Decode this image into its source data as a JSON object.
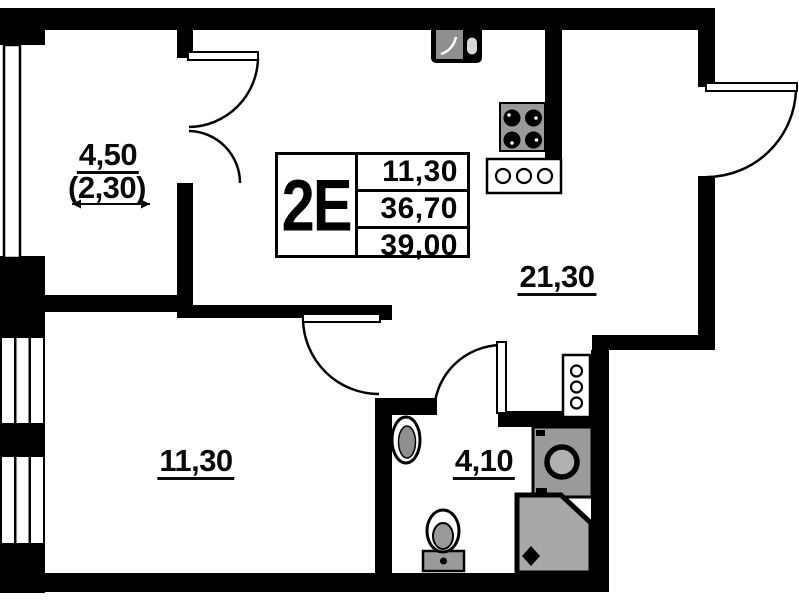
{
  "unit_card": {
    "type": "2E",
    "areas": [
      "11,30",
      "36,70",
      "39,00"
    ]
  },
  "rooms": {
    "balcony": {
      "area": "4,50",
      "reduced_area": "(2,30)"
    },
    "living_kitchen": {
      "area": "21,30"
    },
    "bedroom": {
      "area": "11,30"
    },
    "bathroom": {
      "area": "4,10"
    }
  },
  "fixtures": [
    "kitchen-sink",
    "stove-four-burner",
    "cooktop-three-ring",
    "hall-hook-rack",
    "washbasin",
    "washing-machine",
    "toilet",
    "shower-cabin"
  ],
  "colors": {
    "wall": "#000000",
    "fixture_gray": "#9a9a9a",
    "background": "#ffffff"
  }
}
